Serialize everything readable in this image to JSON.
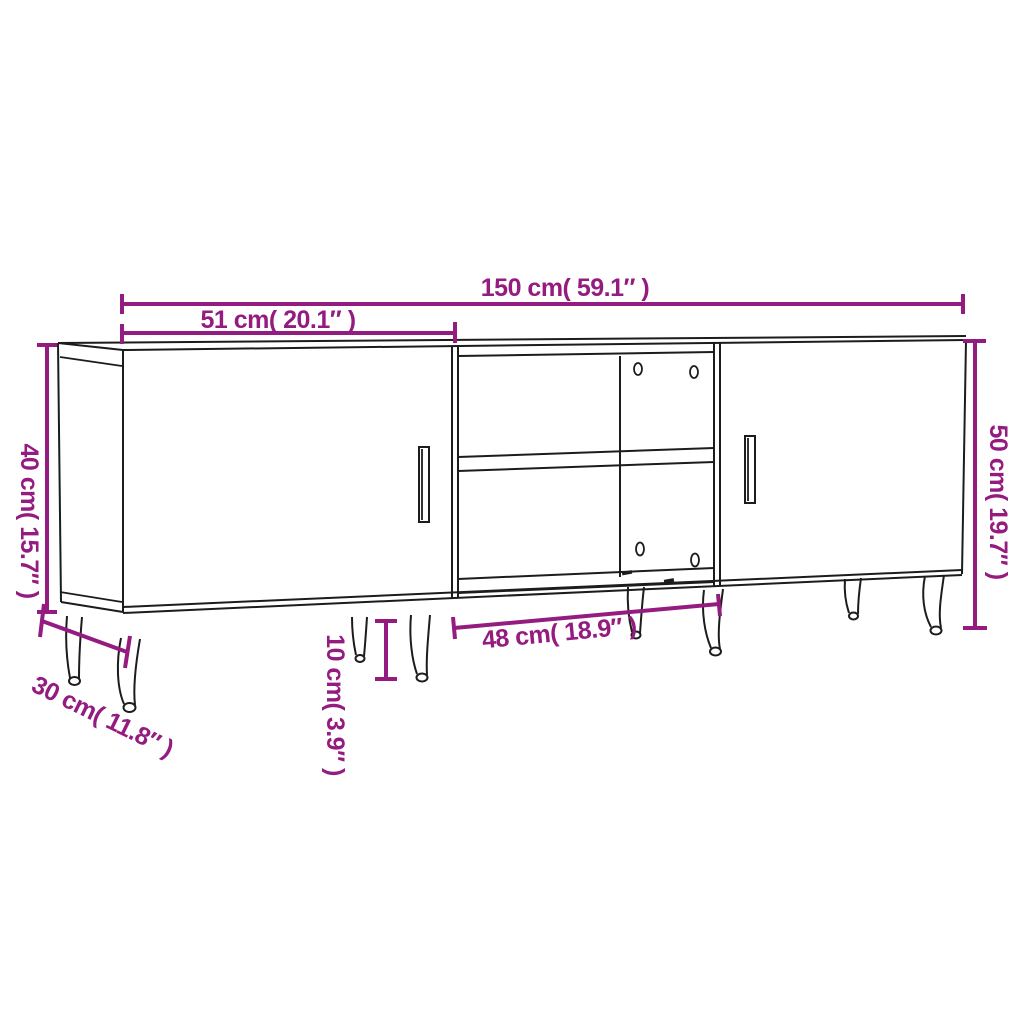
{
  "diagram": {
    "type": "furniture-dimension-diagram",
    "subject": "TV cabinet with two doors, open middle shelf and metal legs",
    "background_color": "#ffffff",
    "outline_color": "#1c1c1c",
    "accent_color": "#941b80",
    "dimensions": {
      "total_width": "150 cm( 59.1″ )",
      "door_width": "51 cm( 20.1″ )",
      "left_height": "40 cm( 15.7″ )",
      "right_height": "50 cm( 19.7″ )",
      "middle_width": "48 cm( 18.9″ )",
      "depth": "30 cm( 11.8″ )",
      "leg_height": "10 cm( 3.9″ )"
    }
  }
}
